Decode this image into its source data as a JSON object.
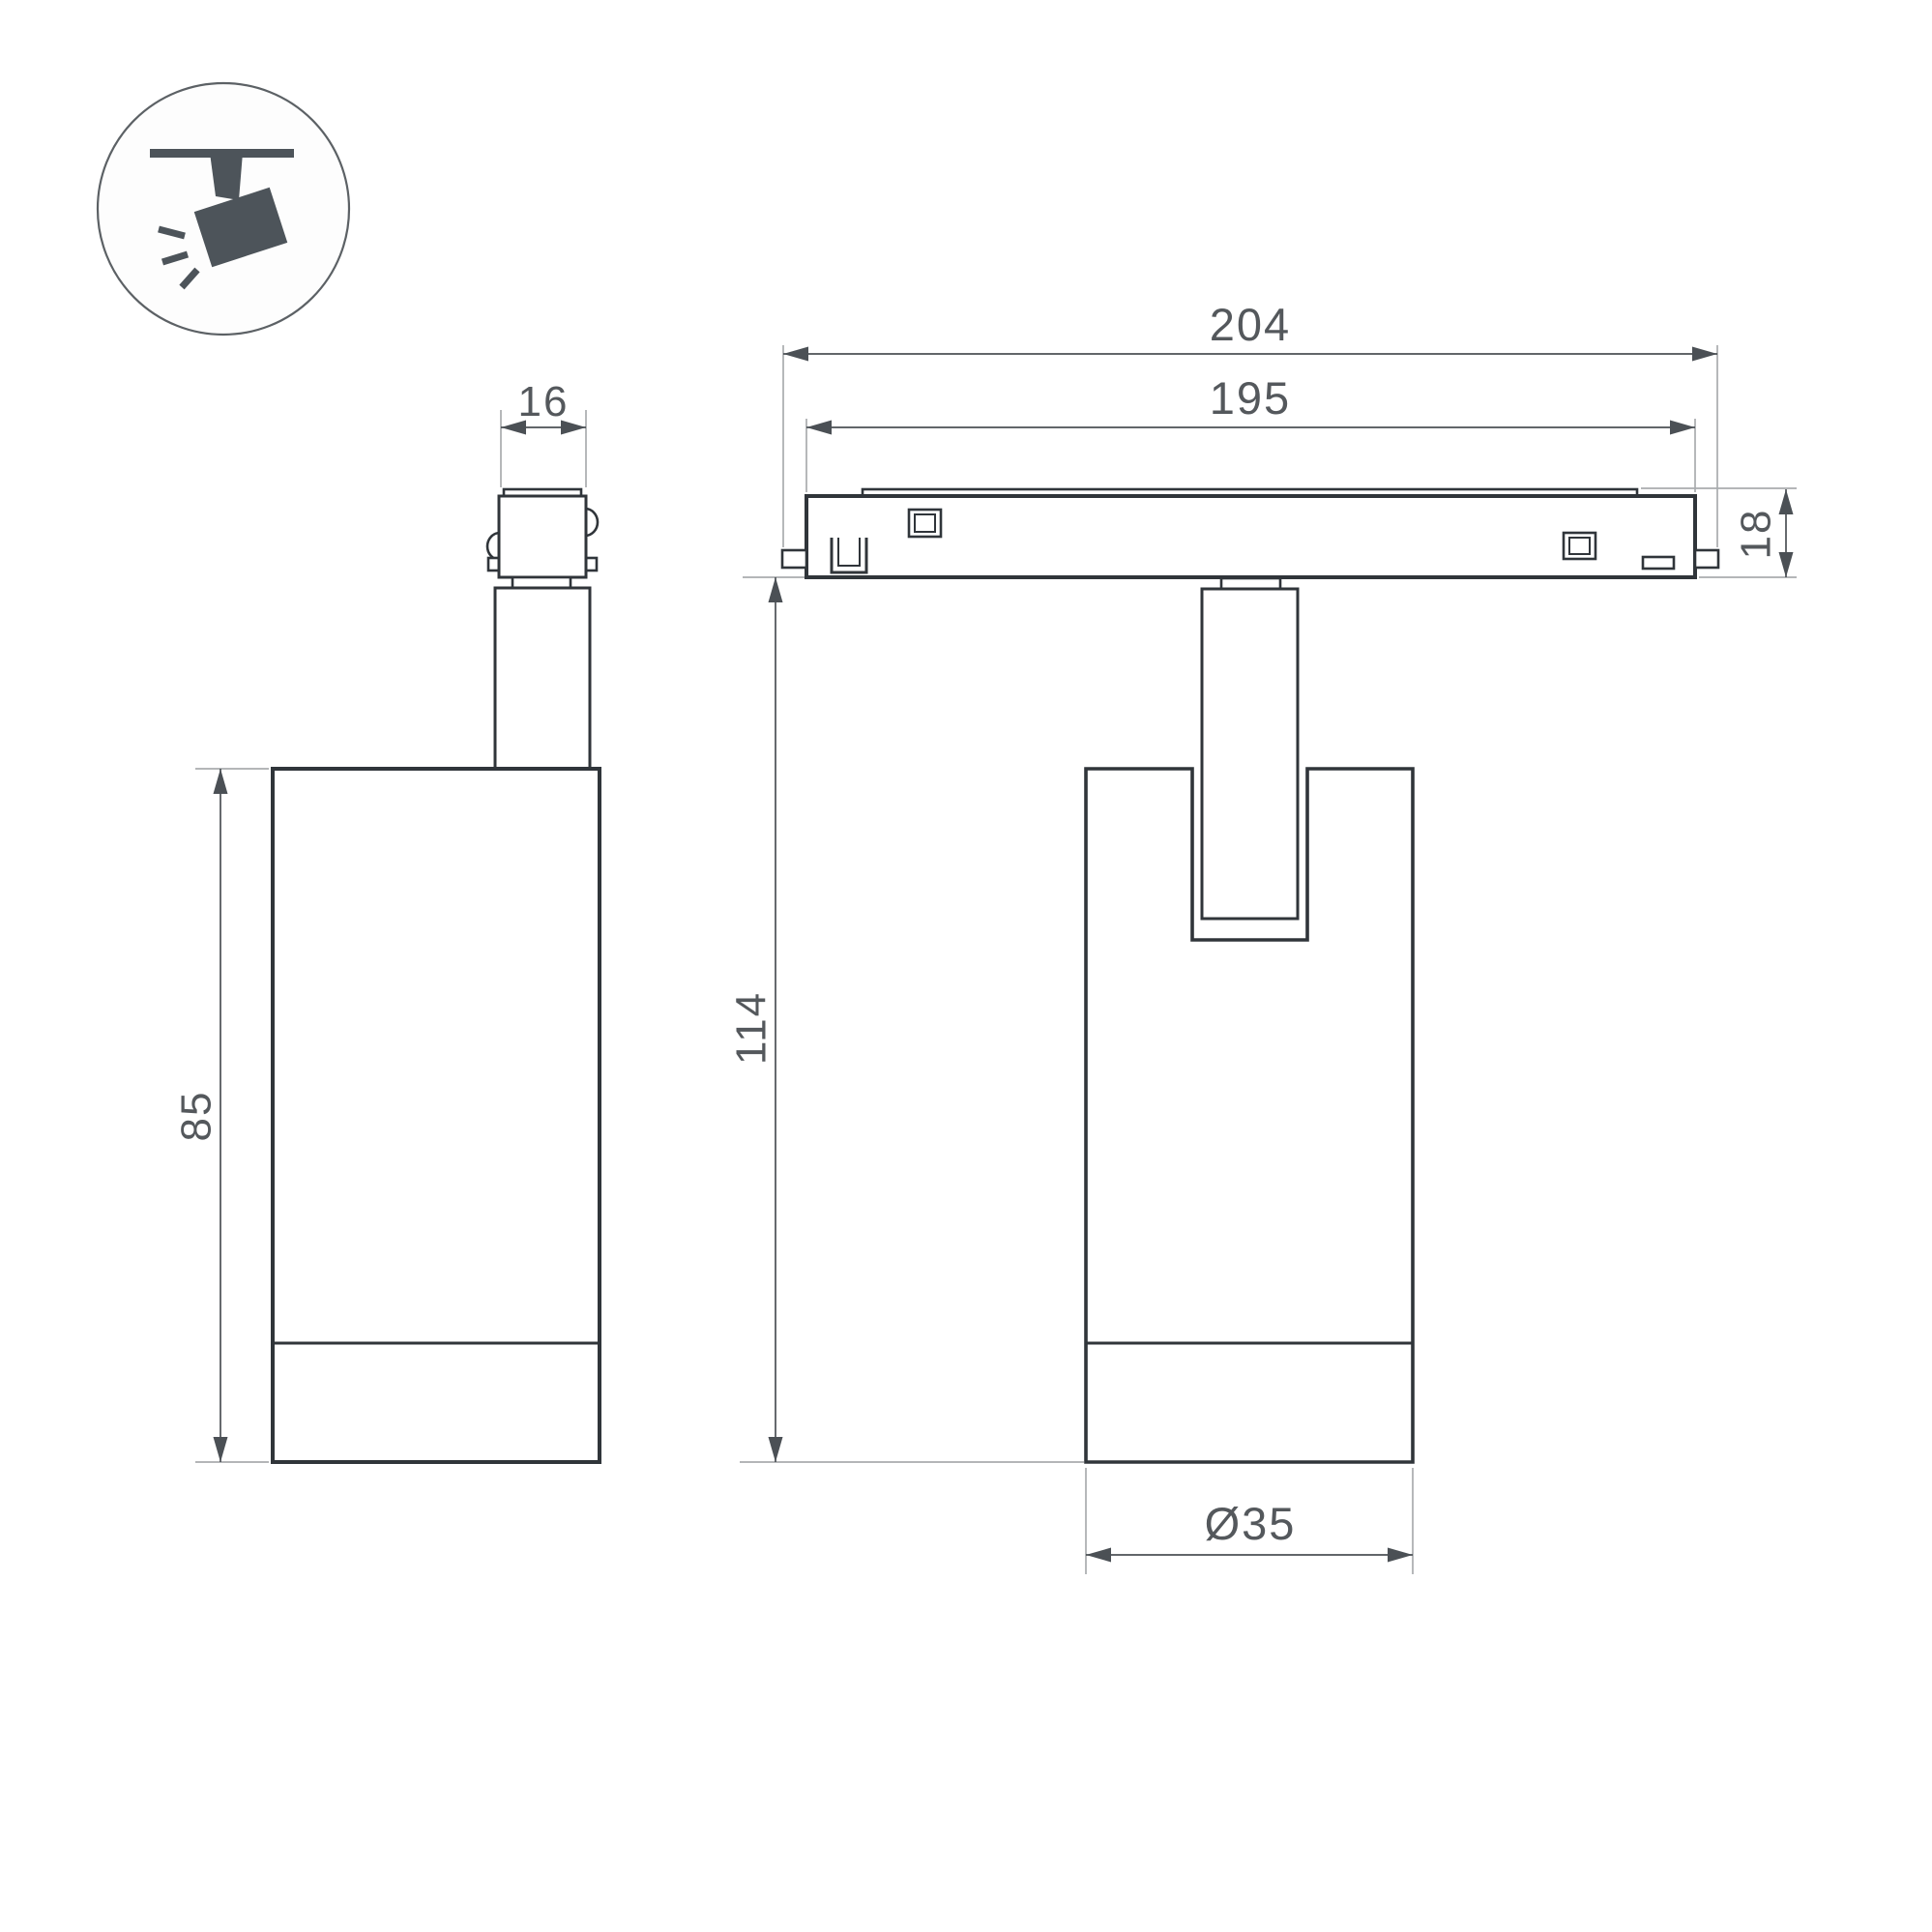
{
  "drawing": {
    "type": "technical-dimension-drawing",
    "product": "ceiling track spotlight",
    "icon": {
      "name": "ceiling-track-spotlight-icon"
    },
    "dimensions": {
      "stem_width": "16",
      "body_height": "85",
      "track_overall_length": "204",
      "track_inner_length": "195",
      "track_height": "18",
      "fixture_height": "114",
      "body_diameter": "Ø35"
    },
    "colors": {
      "background": "#ffffff",
      "outline": "#30353a",
      "dimension_line": "#4b5055",
      "extension_line": "#a9acae",
      "dimension_text": "#54585c",
      "icon_fill": "#4d545a"
    }
  }
}
